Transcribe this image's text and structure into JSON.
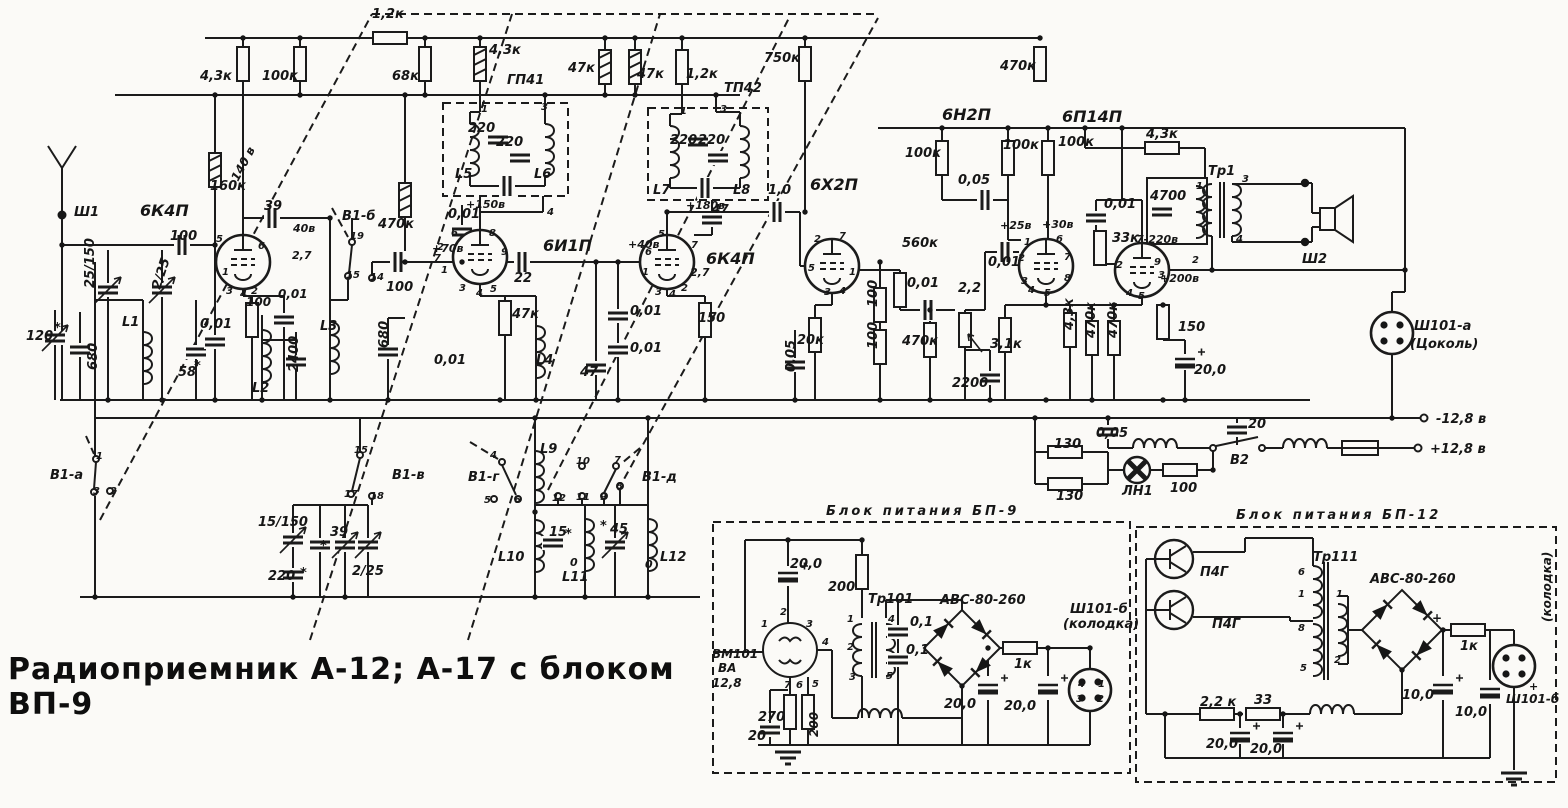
{
  "title": "Радиоприемник А-12; А-17 с блоком ВП-9",
  "schematic": {
    "tubes": [
      "6К4П",
      "6И1П",
      "6К4П",
      "6Х2П",
      "6Н2П",
      "6П14П"
    ],
    "filters": [
      "ГП41",
      "ТП42"
    ],
    "switch_sections": [
      "В1-а",
      "В1-б",
      "В1-в",
      "В1-г",
      "В1-д",
      "В2"
    ],
    "connectors": [
      "Ш1",
      "Ш2",
      "Ш101-а (Цоколь)",
      "Ш101-б (колодка)"
    ],
    "supply_terminals": [
      "-12,8 в",
      "+12,8 в"
    ],
    "power_blocks": [
      "Блок питания БП-9",
      "Блок питания БП-12"
    ],
    "transformers": [
      "Тр1",
      "Тр101",
      "Тр111"
    ],
    "lamp": "ЛН1",
    "vibrator": "ВМ101 ВА 12,8",
    "transistors": [
      "П4Г",
      "П4Г"
    ],
    "rectifiers": [
      "АВС-80-260",
      "АВС-80-260"
    ]
  },
  "labels": [
    {
      "t": "1,2к",
      "x": 372,
      "y": 18
    },
    {
      "t": "4,3к",
      "x": 200,
      "y": 80
    },
    {
      "t": "100к",
      "x": 262,
      "y": 80
    },
    {
      "t": "68к",
      "x": 392,
      "y": 80
    },
    {
      "t": "4,3к",
      "x": 489,
      "y": 54
    },
    {
      "t": "ГП41",
      "x": 507,
      "y": 84
    },
    {
      "t": "47к",
      "x": 568,
      "y": 72
    },
    {
      "t": "47к",
      "x": 637,
      "y": 78
    },
    {
      "t": "1,2к",
      "x": 686,
      "y": 78
    },
    {
      "t": "ТП42",
      "x": 724,
      "y": 92
    },
    {
      "t": "750к",
      "x": 764,
      "y": 62
    },
    {
      "t": "470к",
      "x": 1000,
      "y": 70
    },
    {
      "t": "160к",
      "x": 210,
      "y": 190
    },
    {
      "t": "140 в",
      "x": 238,
      "y": 182,
      "r": -62,
      "s": 12
    },
    {
      "t": "6К4П",
      "x": 140,
      "y": 216,
      "s": 16
    },
    {
      "t": "Ш1",
      "x": 74,
      "y": 216
    },
    {
      "t": "100",
      "x": 170,
      "y": 240
    },
    {
      "t": "39",
      "x": 264,
      "y": 210
    },
    {
      "t": "40в",
      "x": 293,
      "y": 232,
      "s": 11
    },
    {
      "t": "2,7",
      "x": 292,
      "y": 259,
      "s": 11
    },
    {
      "t": "100",
      "x": 246,
      "y": 306,
      "s": 12
    },
    {
      "t": "0,01",
      "x": 278,
      "y": 298,
      "s": 12
    },
    {
      "t": "0,01",
      "x": 200,
      "y": 328
    },
    {
      "t": "58",
      "x": 178,
      "y": 376
    },
    {
      "t": "*",
      "x": 194,
      "y": 370
    },
    {
      "t": "120",
      "x": 26,
      "y": 340
    },
    {
      "t": "*",
      "x": 54,
      "y": 332
    },
    {
      "t": "680",
      "x": 97,
      "y": 370,
      "r": -90
    },
    {
      "t": "25/150",
      "x": 94,
      "y": 288,
      "r": -90
    },
    {
      "t": "2/25",
      "x": 160,
      "y": 290,
      "r": -72
    },
    {
      "t": "L1",
      "x": 122,
      "y": 326
    },
    {
      "t": "L2",
      "x": 252,
      "y": 392
    },
    {
      "t": "2400",
      "x": 298,
      "y": 372,
      "r": -90
    },
    {
      "t": "L3",
      "x": 320,
      "y": 330
    },
    {
      "t": "680",
      "x": 388,
      "y": 348,
      "r": -90
    },
    {
      "t": "В1-а",
      "x": 50,
      "y": 479
    },
    {
      "t": "В1-б",
      "x": 342,
      "y": 220
    },
    {
      "t": "470к",
      "x": 378,
      "y": 228
    },
    {
      "t": "100",
      "x": 386,
      "y": 291
    },
    {
      "t": "0,01",
      "x": 448,
      "y": 218
    },
    {
      "t": "+70в",
      "x": 432,
      "y": 252,
      "s": 11
    },
    {
      "t": "+150в",
      "x": 466,
      "y": 208,
      "s": 11
    },
    {
      "t": "0,01",
      "x": 434,
      "y": 364
    },
    {
      "t": "L5",
      "x": 455,
      "y": 178
    },
    {
      "t": "L6",
      "x": 534,
      "y": 178
    },
    {
      "t": "220",
      "x": 468,
      "y": 132
    },
    {
      "t": "220",
      "x": 496,
      "y": 146
    },
    {
      "t": "6И1П",
      "x": 543,
      "y": 251,
      "s": 16
    },
    {
      "t": "22",
      "x": 514,
      "y": 282
    },
    {
      "t": "47к",
      "x": 512,
      "y": 318
    },
    {
      "t": "L4",
      "x": 536,
      "y": 364
    },
    {
      "t": "47",
      "x": 580,
      "y": 376
    },
    {
      "t": "0,01",
      "x": 630,
      "y": 315
    },
    {
      "t": "0,01",
      "x": 630,
      "y": 352
    },
    {
      "t": "+40в",
      "x": 628,
      "y": 248,
      "s": 11
    },
    {
      "t": "6К4П",
      "x": 706,
      "y": 264,
      "s": 16
    },
    {
      "t": "2,7",
      "x": 690,
      "y": 276,
      "s": 11
    },
    {
      "t": "150",
      "x": 698,
      "y": 322
    },
    {
      "t": "L7",
      "x": 653,
      "y": 194
    },
    {
      "t": "L8",
      "x": 733,
      "y": 194
    },
    {
      "t": "220",
      "x": 670,
      "y": 144
    },
    {
      "t": "220",
      "x": 698,
      "y": 144
    },
    {
      "t": "+180в",
      "x": 686,
      "y": 209,
      "s": 11
    },
    {
      "t": "47",
      "x": 712,
      "y": 213,
      "s": 12
    },
    {
      "t": "1,0",
      "x": 768,
      "y": 194
    },
    {
      "t": "0,05",
      "x": 795,
      "y": 372,
      "r": -90
    },
    {
      "t": "6Х2П",
      "x": 810,
      "y": 190,
      "s": 16
    },
    {
      "t": "20к",
      "x": 797,
      "y": 344
    },
    {
      "t": "100",
      "x": 877,
      "y": 307,
      "r": -90
    },
    {
      "t": "100",
      "x": 877,
      "y": 349,
      "r": -90
    },
    {
      "t": "560к",
      "x": 902,
      "y": 247
    },
    {
      "t": "0,01",
      "x": 907,
      "y": 287
    },
    {
      "t": "2,2",
      "x": 958,
      "y": 292
    },
    {
      "t": "470к",
      "x": 902,
      "y": 345
    },
    {
      "t": "2200",
      "x": 952,
      "y": 387
    },
    {
      "t": "3,1к",
      "x": 990,
      "y": 348
    },
    {
      "t": "0,01",
      "x": 988,
      "y": 266
    },
    {
      "t": "6Н2П",
      "x": 942,
      "y": 120,
      "s": 16
    },
    {
      "t": "100к",
      "x": 905,
      "y": 157
    },
    {
      "t": "0,05",
      "x": 958,
      "y": 184
    },
    {
      "t": "100к",
      "x": 1003,
      "y": 149
    },
    {
      "t": "100к",
      "x": 1058,
      "y": 146
    },
    {
      "t": "+25в",
      "x": 1000,
      "y": 229,
      "s": 11
    },
    {
      "t": "+30в",
      "x": 1042,
      "y": 228,
      "s": 11
    },
    {
      "t": "4,3к",
      "x": 1073,
      "y": 330,
      "r": -90
    },
    {
      "t": "470к",
      "x": 1095,
      "y": 338,
      "r": -90
    },
    {
      "t": "470к",
      "x": 1117,
      "y": 338,
      "r": -90
    },
    {
      "t": "33к",
      "x": 1112,
      "y": 242
    },
    {
      "t": "7-220в",
      "x": 1136,
      "y": 243,
      "s": 11
    },
    {
      "t": "0,01",
      "x": 1104,
      "y": 208
    },
    {
      "t": "4700",
      "x": 1150,
      "y": 200
    },
    {
      "t": "6П14П",
      "x": 1062,
      "y": 122,
      "s": 16
    },
    {
      "t": "4,3к",
      "x": 1146,
      "y": 138
    },
    {
      "t": "Тр1",
      "x": 1208,
      "y": 175
    },
    {
      "t": "+200в",
      "x": 1160,
      "y": 282,
      "s": 11
    },
    {
      "t": "150",
      "x": 1178,
      "y": 331
    },
    {
      "t": "20,0",
      "x": 1194,
      "y": 374
    },
    {
      "t": "Ш2",
      "x": 1302,
      "y": 263
    },
    {
      "t": "Ш101-а",
      "x": 1414,
      "y": 330
    },
    {
      "t": "(Цоколь)",
      "x": 1410,
      "y": 348
    },
    {
      "t": "-12,8 в",
      "x": 1436,
      "y": 423
    },
    {
      "t": "+12,8 в",
      "x": 1430,
      "y": 453
    },
    {
      "t": "0,05",
      "x": 1096,
      "y": 437
    },
    {
      "t": "20",
      "x": 1248,
      "y": 428
    },
    {
      "t": "В2",
      "x": 1230,
      "y": 464
    },
    {
      "t": "130",
      "x": 1054,
      "y": 448
    },
    {
      "t": "130",
      "x": 1056,
      "y": 500
    },
    {
      "t": "ЛН1",
      "x": 1122,
      "y": 495
    },
    {
      "t": "100",
      "x": 1170,
      "y": 492
    },
    {
      "t": "В1-в",
      "x": 392,
      "y": 479
    },
    {
      "t": "15/150",
      "x": 258,
      "y": 526
    },
    {
      "t": "39",
      "x": 330,
      "y": 536
    },
    {
      "t": "*",
      "x": 320,
      "y": 550
    },
    {
      "t": "220",
      "x": 268,
      "y": 580
    },
    {
      "t": "*",
      "x": 300,
      "y": 577
    },
    {
      "t": "2/25",
      "x": 352,
      "y": 575
    },
    {
      "t": "В1-г",
      "x": 468,
      "y": 481
    },
    {
      "t": "В1-д",
      "x": 642,
      "y": 481
    },
    {
      "t": "L9",
      "x": 540,
      "y": 453
    },
    {
      "t": "L10",
      "x": 498,
      "y": 561
    },
    {
      "t": "L11",
      "x": 562,
      "y": 581
    },
    {
      "t": "L12",
      "x": 660,
      "y": 561
    },
    {
      "t": "15",
      "x": 549,
      "y": 536
    },
    {
      "t": "*",
      "x": 565,
      "y": 538
    },
    {
      "t": "45",
      "x": 610,
      "y": 533
    },
    {
      "t": "*",
      "x": 600,
      "y": 530
    },
    {
      "t": "0",
      "x": 570,
      "y": 566,
      "s": 11
    },
    {
      "t": "0",
      "x": 645,
      "y": 568,
      "s": 11
    },
    {
      "t": "5",
      "x": 216,
      "y": 242,
      "s": 10
    },
    {
      "t": "6",
      "x": 258,
      "y": 249,
      "s": 10
    },
    {
      "t": "1",
      "x": 222,
      "y": 275,
      "s": 10
    },
    {
      "t": "3",
      "x": 226,
      "y": 294,
      "s": 10
    },
    {
      "t": "4",
      "x": 240,
      "y": 297,
      "s": 10
    },
    {
      "t": "2",
      "x": 251,
      "y": 294,
      "s": 10
    },
    {
      "t": "6",
      "x": 451,
      "y": 236,
      "s": 10
    },
    {
      "t": "8",
      "x": 489,
      "y": 236,
      "s": 10
    },
    {
      "t": "9",
      "x": 501,
      "y": 255,
      "s": 10
    },
    {
      "t": "7",
      "x": 434,
      "y": 261,
      "s": 10
    },
    {
      "t": "1",
      "x": 441,
      "y": 273,
      "s": 10
    },
    {
      "t": "2",
      "x": 437,
      "y": 250,
      "s": 10
    },
    {
      "t": "3",
      "x": 459,
      "y": 291,
      "s": 10
    },
    {
      "t": "4",
      "x": 476,
      "y": 296,
      "s": 10
    },
    {
      "t": "5",
      "x": 490,
      "y": 292,
      "s": 10
    },
    {
      "t": "5",
      "x": 658,
      "y": 237,
      "s": 10
    },
    {
      "t": "6",
      "x": 645,
      "y": 255,
      "s": 10
    },
    {
      "t": "1",
      "x": 642,
      "y": 275,
      "s": 10
    },
    {
      "t": "3",
      "x": 655,
      "y": 295,
      "s": 10
    },
    {
      "t": "4",
      "x": 669,
      "y": 297,
      "s": 10
    },
    {
      "t": "2",
      "x": 681,
      "y": 291,
      "s": 10
    },
    {
      "t": "7",
      "x": 691,
      "y": 248,
      "s": 10
    },
    {
      "t": "2",
      "x": 814,
      "y": 242,
      "s": 10
    },
    {
      "t": "7",
      "x": 839,
      "y": 239,
      "s": 10
    },
    {
      "t": "5",
      "x": 808,
      "y": 271,
      "s": 10
    },
    {
      "t": "1",
      "x": 849,
      "y": 275,
      "s": 10
    },
    {
      "t": "3",
      "x": 824,
      "y": 295,
      "s": 10
    },
    {
      "t": "4",
      "x": 839,
      "y": 294,
      "s": 10
    },
    {
      "t": "1",
      "x": 1024,
      "y": 245,
      "s": 10
    },
    {
      "t": "6",
      "x": 1056,
      "y": 242,
      "s": 10
    },
    {
      "t": "2",
      "x": 1018,
      "y": 261,
      "s": 10
    },
    {
      "t": "7",
      "x": 1064,
      "y": 260,
      "s": 10
    },
    {
      "t": "3",
      "x": 1021,
      "y": 284,
      "s": 10
    },
    {
      "t": "8",
      "x": 1064,
      "y": 281,
      "s": 10
    },
    {
      "t": "4",
      "x": 1028,
      "y": 293,
      "s": 10
    },
    {
      "t": "5",
      "x": 1044,
      "y": 296,
      "s": 10
    },
    {
      "t": "2",
      "x": 1116,
      "y": 268,
      "s": 10
    },
    {
      "t": "9",
      "x": 1154,
      "y": 265,
      "s": 10
    },
    {
      "t": "3",
      "x": 1158,
      "y": 278,
      "s": 10
    },
    {
      "t": "4",
      "x": 1126,
      "y": 296,
      "s": 10
    },
    {
      "t": "5",
      "x": 1138,
      "y": 299,
      "s": 10
    },
    {
      "t": "3",
      "x": 1242,
      "y": 182,
      "s": 10
    },
    {
      "t": "4",
      "x": 1236,
      "y": 242,
      "s": 10
    },
    {
      "t": "1",
      "x": 1196,
      "y": 189,
      "s": 10
    },
    {
      "t": "2",
      "x": 1192,
      "y": 263,
      "s": 10
    },
    {
      "t": "1",
      "x": 481,
      "y": 112,
      "s": 10
    },
    {
      "t": "3",
      "x": 541,
      "y": 110,
      "s": 10
    },
    {
      "t": "4",
      "x": 547,
      "y": 215,
      "s": 10
    },
    {
      "t": "1",
      "x": 680,
      "y": 114,
      "s": 10
    },
    {
      "t": "3",
      "x": 720,
      "y": 112,
      "s": 10
    },
    {
      "t": "1",
      "x": 96,
      "y": 459,
      "s": 10
    },
    {
      "t": "3",
      "x": 93,
      "y": 494,
      "s": 10
    },
    {
      "t": "2",
      "x": 110,
      "y": 494,
      "s": 10
    },
    {
      "t": "19",
      "x": 350,
      "y": 239,
      "s": 10
    },
    {
      "t": "15",
      "x": 346,
      "y": 278,
      "s": 10
    },
    {
      "t": "14",
      "x": 370,
      "y": 280,
      "s": 10
    },
    {
      "t": "15",
      "x": 354,
      "y": 453,
      "s": 10
    },
    {
      "t": "17",
      "x": 344,
      "y": 497,
      "s": 10
    },
    {
      "t": "18",
      "x": 370,
      "y": 499,
      "s": 10
    },
    {
      "t": "4",
      "x": 490,
      "y": 458,
      "s": 10
    },
    {
      "t": "5",
      "x": 484,
      "y": 503,
      "s": 10
    },
    {
      "t": "6",
      "x": 514,
      "y": 503,
      "s": 10
    },
    {
      "t": "10",
      "x": 576,
      "y": 464,
      "s": 10
    },
    {
      "t": "7",
      "x": 614,
      "y": 463,
      "s": 10
    },
    {
      "t": "12",
      "x": 552,
      "y": 501,
      "s": 10
    },
    {
      "t": "11",
      "x": 576,
      "y": 500,
      "s": 10
    },
    {
      "t": "9",
      "x": 600,
      "y": 500,
      "s": 10
    },
    {
      "t": "8",
      "x": 616,
      "y": 489,
      "s": 10
    },
    {
      "t": "Блок питания БП-9",
      "x": 826,
      "y": 515,
      "ls": 3
    },
    {
      "t": "20,0",
      "x": 790,
      "y": 568
    },
    {
      "t": "200",
      "x": 828,
      "y": 591
    },
    {
      "t": "Тр101",
      "x": 868,
      "y": 603
    },
    {
      "t": "ВМ101",
      "x": 712,
      "y": 658,
      "s": 12
    },
    {
      "t": "ВА",
      "x": 718,
      "y": 672,
      "s": 12
    },
    {
      "t": "12,8",
      "x": 712,
      "y": 687,
      "s": 12
    },
    {
      "t": "270",
      "x": 758,
      "y": 721
    },
    {
      "t": "200",
      "x": 818,
      "y": 737,
      "r": -90,
      "s": 12
    },
    {
      "t": "20",
      "x": 748,
      "y": 740
    },
    {
      "t": "0,1",
      "x": 910,
      "y": 626
    },
    {
      "t": "0,1",
      "x": 906,
      "y": 654
    },
    {
      "t": "АВС-80-260",
      "x": 940,
      "y": 604
    },
    {
      "t": "1к",
      "x": 1014,
      "y": 668
    },
    {
      "t": "20,0",
      "x": 944,
      "y": 708
    },
    {
      "t": "20,0",
      "x": 1004,
      "y": 710
    },
    {
      "t": "Ш101-б",
      "x": 1070,
      "y": 613
    },
    {
      "t": "(колодка)",
      "x": 1063,
      "y": 628
    },
    {
      "t": "2",
      "x": 780,
      "y": 615,
      "s": 10
    },
    {
      "t": "1",
      "x": 761,
      "y": 627,
      "s": 10
    },
    {
      "t": "3",
      "x": 806,
      "y": 627,
      "s": 10
    },
    {
      "t": "4",
      "x": 822,
      "y": 645,
      "s": 10
    },
    {
      "t": "7",
      "x": 784,
      "y": 688,
      "s": 10
    },
    {
      "t": "6",
      "x": 796,
      "y": 688,
      "s": 10
    },
    {
      "t": "5",
      "x": 812,
      "y": 687,
      "s": 10
    },
    {
      "t": "1",
      "x": 847,
      "y": 622,
      "s": 10
    },
    {
      "t": "2",
      "x": 847,
      "y": 650,
      "s": 10
    },
    {
      "t": "3",
      "x": 849,
      "y": 680,
      "s": 10
    },
    {
      "t": "4",
      "x": 888,
      "y": 622,
      "s": 10
    },
    {
      "t": "5",
      "x": 886,
      "y": 679,
      "s": 10
    },
    {
      "t": "4",
      "x": 1078,
      "y": 687,
      "s": 10
    },
    {
      "t": "1",
      "x": 1098,
      "y": 687,
      "s": 10
    },
    {
      "t": "3",
      "x": 1076,
      "y": 702,
      "s": 10
    },
    {
      "t": "2",
      "x": 1097,
      "y": 702,
      "s": 10
    },
    {
      "t": "Блок питания БП-12",
      "x": 1236,
      "y": 519,
      "ls": 3
    },
    {
      "t": "П4Г",
      "x": 1200,
      "y": 576
    },
    {
      "t": "П4Г",
      "x": 1212,
      "y": 628
    },
    {
      "t": "Тр111",
      "x": 1313,
      "y": 561
    },
    {
      "t": "АВС-80-260",
      "x": 1370,
      "y": 583
    },
    {
      "t": "+",
      "x": 1432,
      "y": 622,
      "s": 12
    },
    {
      "t": "1к",
      "x": 1460,
      "y": 650
    },
    {
      "t": "10,0",
      "x": 1402,
      "y": 699
    },
    {
      "t": "10,0",
      "x": 1455,
      "y": 716
    },
    {
      "t": "2,2 к",
      "x": 1200,
      "y": 706
    },
    {
      "t": "33",
      "x": 1254,
      "y": 704
    },
    {
      "t": "20,0",
      "x": 1206,
      "y": 748
    },
    {
      "t": "20,0",
      "x": 1250,
      "y": 753
    },
    {
      "t": "Ш101-б",
      "x": 1506,
      "y": 703,
      "s": 12
    },
    {
      "t": "(колодка)",
      "x": 1551,
      "y": 622,
      "r": -90,
      "s": 12
    },
    {
      "t": "+",
      "x": 1529,
      "y": 690,
      "s": 11
    },
    {
      "t": "6",
      "x": 1298,
      "y": 575,
      "s": 10
    },
    {
      "t": "1",
      "x": 1298,
      "y": 597,
      "s": 10
    },
    {
      "t": "8",
      "x": 1298,
      "y": 631,
      "s": 10
    },
    {
      "t": "5",
      "x": 1300,
      "y": 671,
      "s": 10
    },
    {
      "t": "1",
      "x": 1336,
      "y": 597,
      "s": 10
    },
    {
      "t": "2",
      "x": 1334,
      "y": 663,
      "s": 10
    }
  ]
}
